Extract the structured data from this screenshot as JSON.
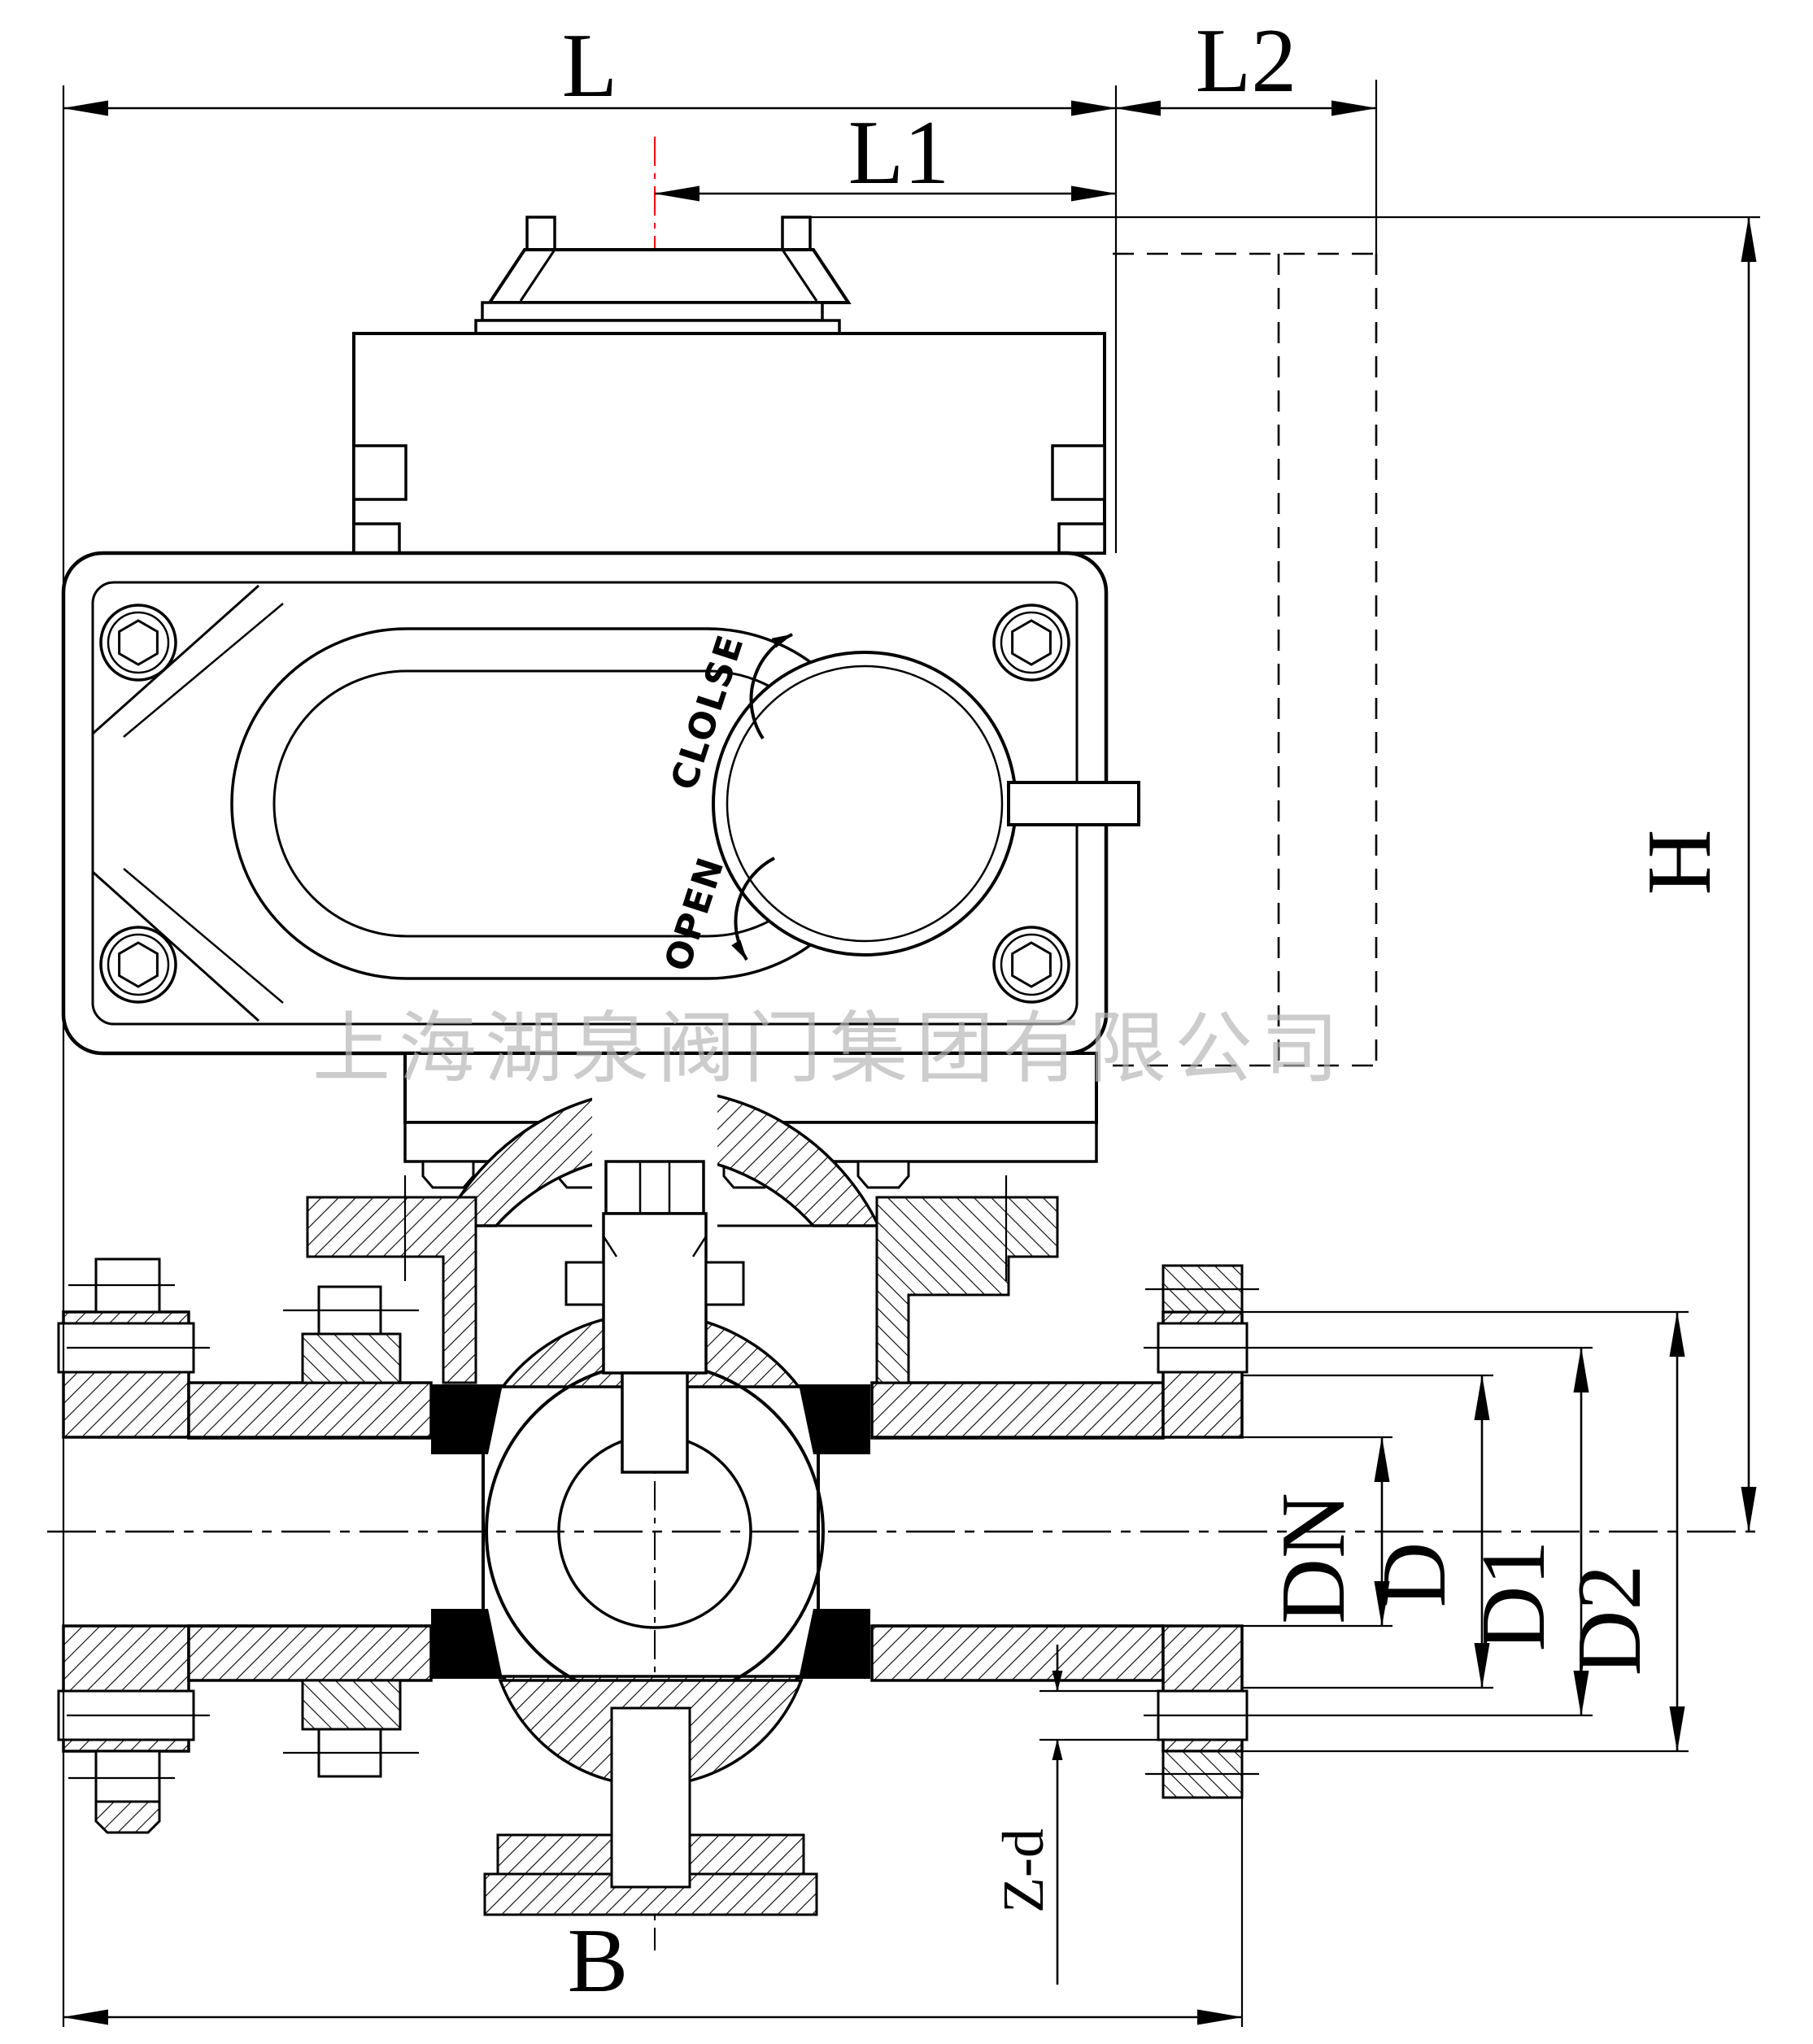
{
  "drawing": {
    "type": "engineering-sectional-drawing",
    "subject": "electric-actuated flanged ball valve",
    "watermark": "上海湖泉阀门集团有限公司",
    "dial": {
      "close": "CLOLSE",
      "open": "OPEN"
    },
    "dimensions": {
      "L": "L",
      "L1": "L1",
      "L2": "L2",
      "H": "H",
      "B": "B",
      "DN": "DN",
      "D": "D",
      "D1": "D1",
      "D2": "D2",
      "Zd": "Z-d"
    },
    "colors": {
      "line": "#000000",
      "centerline_red": "#ff0000",
      "seat_black": "#000000",
      "watermark_gray": "#b5b5b5",
      "background": "#ffffff"
    }
  }
}
